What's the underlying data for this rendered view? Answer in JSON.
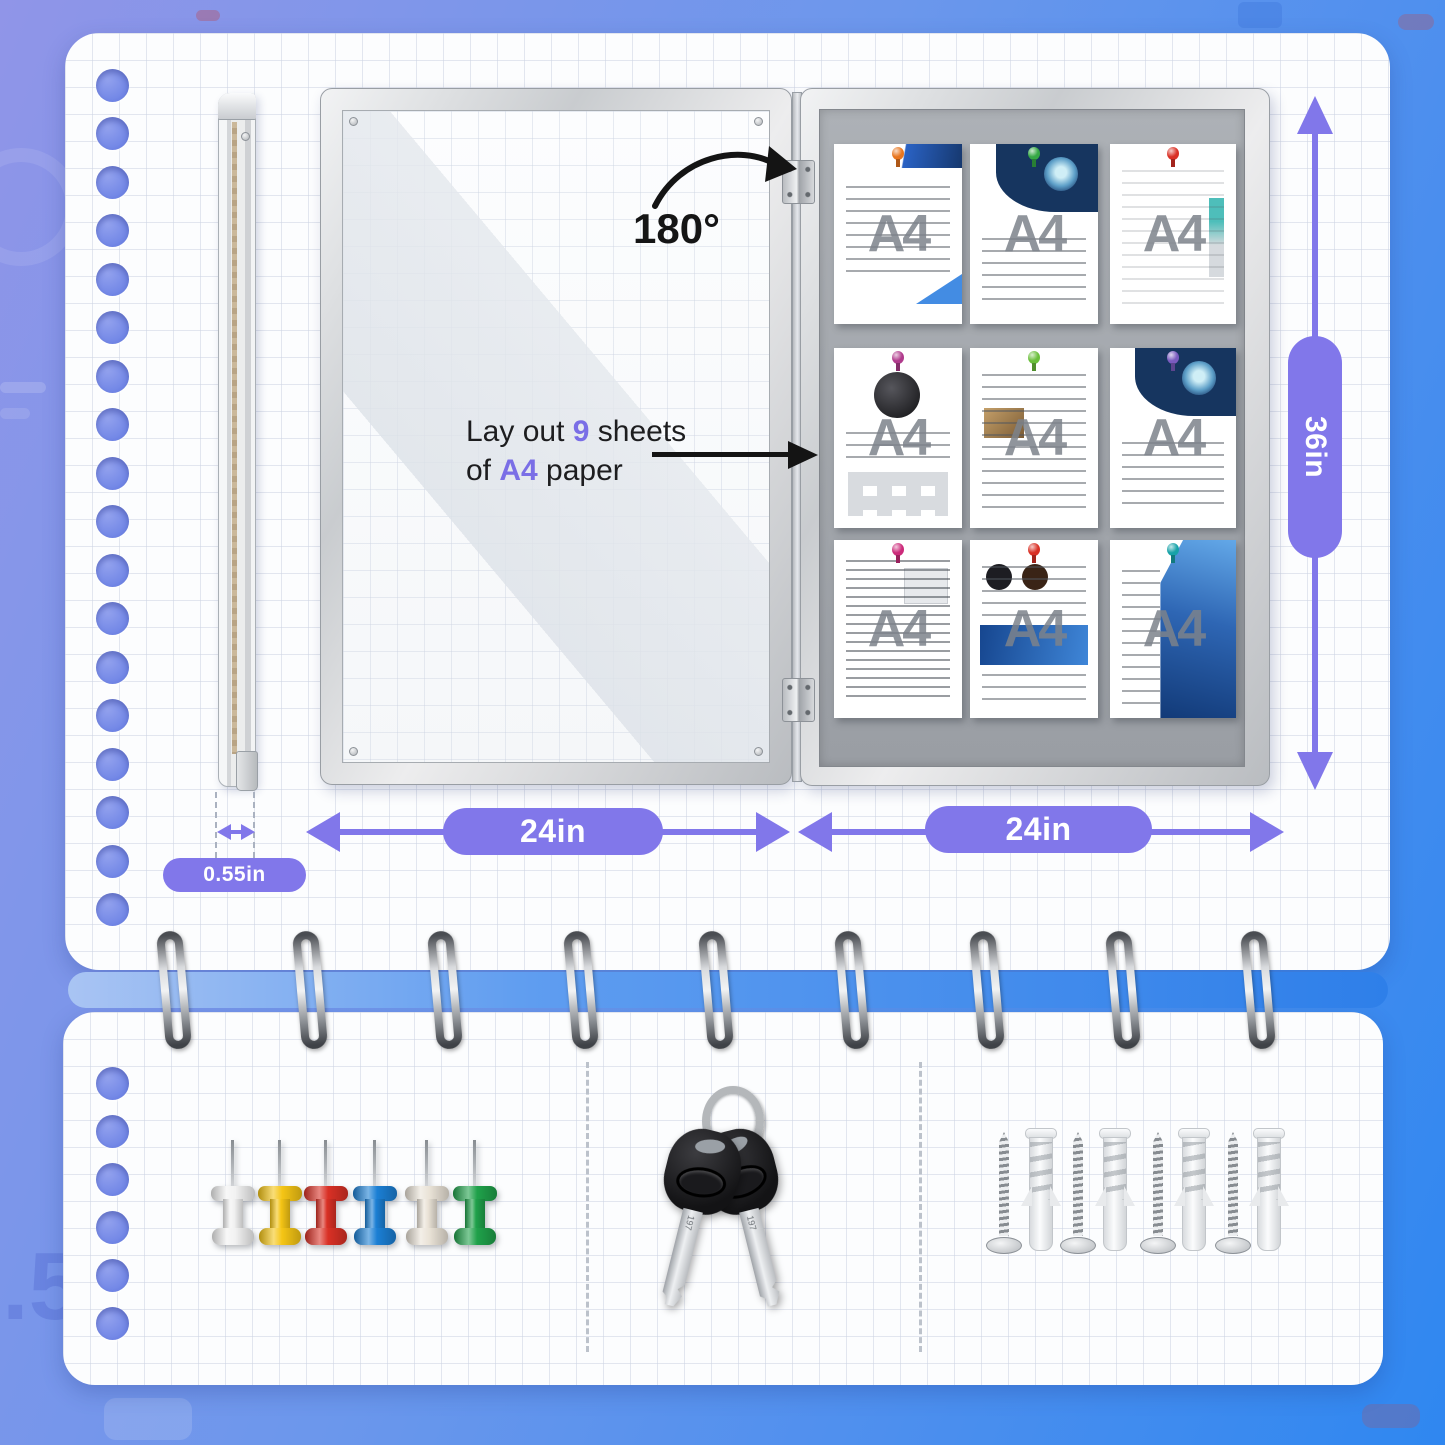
{
  "annotations": {
    "rotation_label": "180°",
    "layout_note": {
      "line1": [
        "Lay out ",
        "9",
        " sheets"
      ],
      "line2": [
        "of ",
        "A4",
        " paper"
      ]
    }
  },
  "dimensions": {
    "height_label": "36in",
    "door_width_label": "24in",
    "board_width_label": "24in",
    "thickness_label": "0.55in"
  },
  "display_board": {
    "sheet_watermark": "A4",
    "pinned_sheets": [
      {
        "theme": "letterhead",
        "pin_color": "#E8751E"
      },
      {
        "theme": "brochure",
        "pin_color": "#35A845"
      },
      {
        "theme": "sketch",
        "pin_color": "#D93025"
      },
      {
        "theme": "product",
        "pin_color": "#B03A8C"
      },
      {
        "theme": "report",
        "pin_color": "#6ABF3A"
      },
      {
        "theme": "brochure",
        "pin_color": "#7A5BBF"
      },
      {
        "theme": "text",
        "pin_color": "#CC2A7A"
      },
      {
        "theme": "food",
        "pin_color": "#D93025"
      },
      {
        "theme": "city",
        "pin_color": "#17A2A8"
      }
    ]
  },
  "accessories": {
    "pushpin_colors": [
      "#F2F2F2",
      "#F5C515",
      "#D93025",
      "#1B7FD4",
      "#EAE3D7",
      "#1FA14A"
    ],
    "key_stamp": "197",
    "key_count": 2,
    "screw_count": 4,
    "anchor_count": 4
  },
  "background_watermark": ".5",
  "colors": {
    "dimension_accent": "#8177EA",
    "text_highlight": "#7A6EE6",
    "background_left": "#9095E8",
    "background_right": "#2F87F0"
  }
}
